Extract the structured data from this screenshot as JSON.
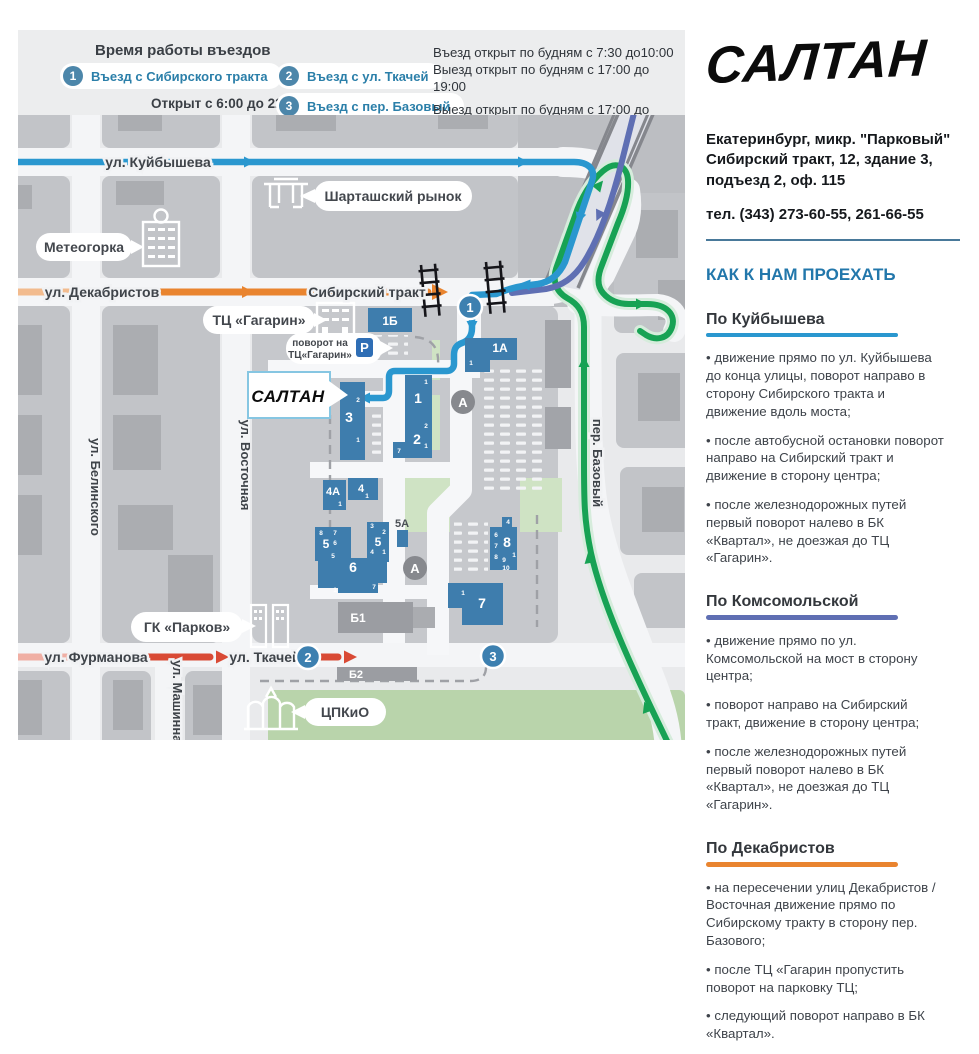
{
  "legend": {
    "title": "Время работы въездов",
    "entries": [
      {
        "num": "1",
        "label": "Въезд с Сибирского тракта",
        "note": "Открыт с 6:00 до 22:00"
      },
      {
        "num": "2",
        "label": "Въезд с ул. Ткачей"
      },
      {
        "num": "3",
        "label": "Въезд с пер. Базовый"
      }
    ],
    "hours": [
      "Въезд открыт по будням с 7:30 до10:00",
      "Выезд открыт по будням с 17:00 до 19:00",
      "Выезд открыт по будням с 17:00 до 19:00"
    ]
  },
  "brand": {
    "logo": "САЛТАН",
    "city_line": "Екатеринбург, микр. \"Парковый\"",
    "addr_line1": "Сибирский тракт, 12, здание 3,",
    "addr_line2": "подъезд 2, оф. 115",
    "phone": "тел. (343) 273-60-55, 261-66-55"
  },
  "directions": {
    "title": "КАК К НАМ ПРОЕХАТЬ",
    "sections": [
      {
        "heading": "По Куйбышева",
        "accent": "#2a97cf",
        "bullets": [
          "движение прямо по ул. Куйбышева до конца улицы, поворот направо в сторону Сибирского тракта и движение вдоль моста;",
          "после автобусной остановки поворот направо на Сибирский тракт и движение в сторону центра;",
          "после железнодорожных путей первый поворот налево в БК «Квартал», не доезжая до ТЦ «Гагарин»."
        ]
      },
      {
        "heading": "По Комсомольской",
        "accent": "#5f6fb3",
        "bullets": [
          "движение прямо по ул. Комсомольской на мост в сторону центра;",
          "поворот направо на Сибирский тракт, движение в сторону центра;",
          "после железнодорожных путей первый поворот налево в БК «Квартал», не доезжая до ТЦ «Гагарин»."
        ]
      },
      {
        "heading": "По Декабристов",
        "accent": "#e9842f",
        "bullets": [
          "на пересечении улиц Декабристов / Восточная движение прямо по Сибирскому тракту в сторону пер. Базового;",
          "после ТЦ «Гагарин пропустить поворот на парковку ТЦ;",
          "следующий поворот направо в БК «Квартал»."
        ]
      }
    ]
  },
  "map": {
    "streets": {
      "kuibysheva": "ул. Куйбышева",
      "dekabristov": "ул. Декабристов",
      "sibirsky": "Сибирский тракт",
      "belinskogo": "ул. Белинского",
      "vostochnaya": "ул. Восточная",
      "furmanova": "ул. Фурманова",
      "tkachey": "ул. Ткачей",
      "mashinnaya": "ул. Машинная",
      "bazovy": "пер. Базовый"
    },
    "callouts": {
      "shartash": "Шарташский рынок",
      "meteogorka": "Метеогорка",
      "gagarin": "ТЦ «Гагарин»",
      "gagarin_turn1": "поворот на",
      "gagarin_turn2": "ТЦ«Гагарин»",
      "saltan": "САЛТАН",
      "parkov": "ГК «Парков»",
      "tspkio": "ЦПКиО"
    },
    "badges": {
      "b1": "1",
      "b2": "2",
      "b3": "3"
    },
    "bus_stop": "А",
    "parking_letter": "P",
    "buildings": {
      "b1b": "1Б",
      "b1a": "1А",
      "b1": "1",
      "b2": "2",
      "b3": "3",
      "b4a": "4А",
      "b4": "4",
      "b5l": "5",
      "b5r": "5",
      "b5a": "5А",
      "b6": "6",
      "b7": "7",
      "b8": "8",
      "bb1": "Б1",
      "bb2": "Б2"
    },
    "e": {
      "b1a": "1",
      "b1": "1",
      "b2_2": "2",
      "b2_1": "1",
      "b2_7": "7",
      "b3_2": "2",
      "b3_1": "1",
      "b4a": "1",
      "b4": "1",
      "b5l_8": "8",
      "b5l_7": "7",
      "b5l_6": "6",
      "b5l_5": "5",
      "b5r_3": "3",
      "b5r_2": "2",
      "b5r_4": "4",
      "b5r_1": "1",
      "b6_1": "1",
      "b6_7": "7",
      "b7_1": "1",
      "b8_4": "4",
      "b8_6": "6",
      "b8_7": "7",
      "b8_8": "8",
      "b8_9": "9",
      "b8_10": "10",
      "b8_1": "1"
    },
    "colors": {
      "route_kuibysheva": "#2a97cf",
      "route_komsomolskaya": "#5f6fb3",
      "route_bazovy": "#17a254",
      "route_dekabristov": "#e9842f",
      "route_tkachey": "#d94a35",
      "building": "#3e7dad",
      "badge": "#3d80b0",
      "accent_header": "#2277ab"
    }
  }
}
